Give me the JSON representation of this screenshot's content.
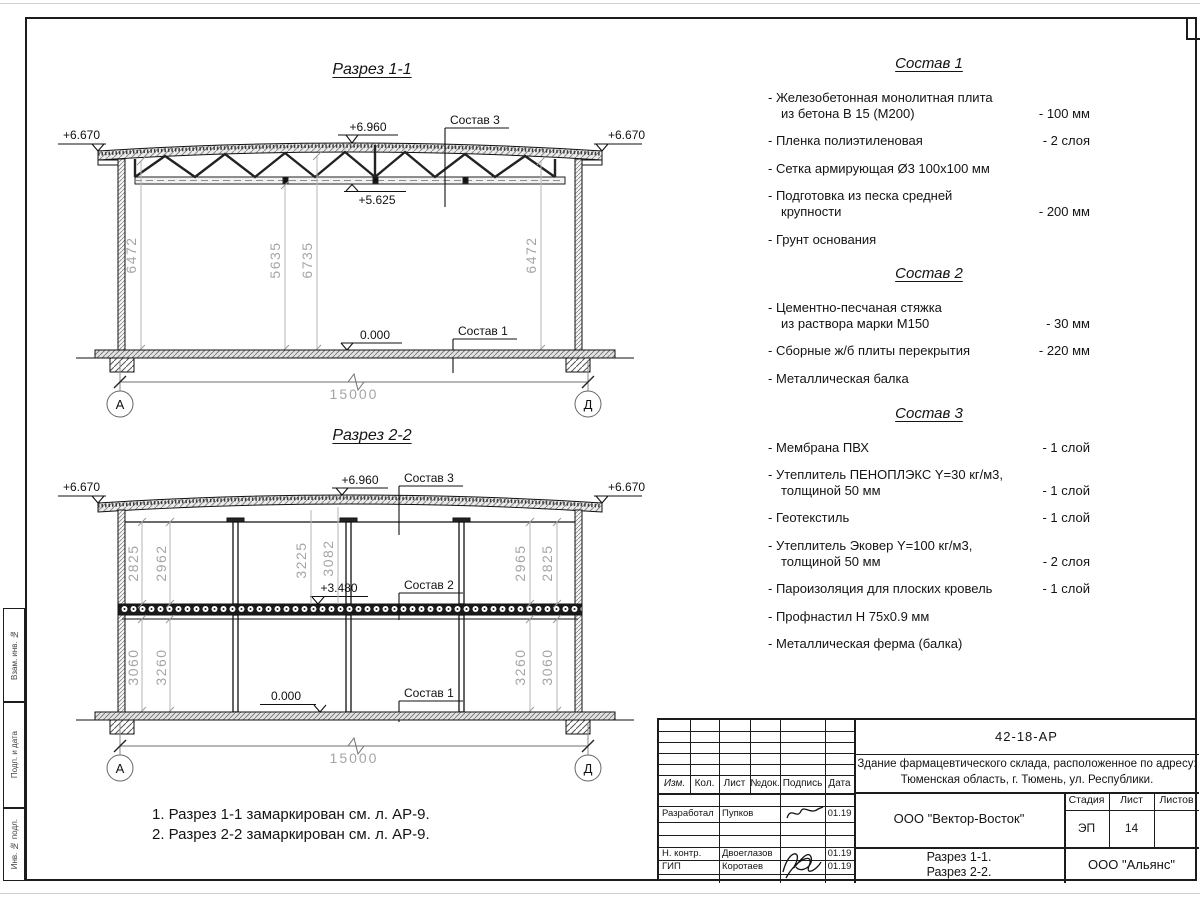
{
  "side_stamp": {
    "cells": [
      "Взам. инв. №",
      "Подп. и дата",
      "Инв. № подл."
    ]
  },
  "sections": {
    "s1": {
      "title": "Разрез 1-1",
      "elev_eave_left": "+6.670",
      "elev_eave_right": "+6.670",
      "elev_ridge": "+6.960",
      "elev_truss_bottom": "+5.625",
      "elev_floor": "0.000",
      "callout_roof": "Состав 3",
      "callout_floor": "Состав 1",
      "dims_vertical": {
        "left": "6472",
        "mid_a": "5635",
        "mid_b": "6735",
        "right": "6472"
      },
      "dim_span": "15000",
      "axis_left": "А",
      "axis_right": "Д"
    },
    "s2": {
      "title": "Разрез 2-2",
      "elev_eave_left": "+6.670",
      "elev_eave_right": "+6.670",
      "elev_ridge": "+6.960",
      "elev_mezzanine": "+3.480",
      "elev_floor": "0.000",
      "callout_roof": "Состав 3",
      "callout_mezz": "Состав 2",
      "callout_floor": "Состав 1",
      "dims_upper": {
        "l1": "2825",
        "l2": "2962",
        "m1": "3225",
        "m2": "3082",
        "r1": "2965",
        "r2": "2825"
      },
      "dims_lower": {
        "l1": "3060",
        "l2": "3260",
        "r1": "3260",
        "r2": "3060"
      },
      "dim_span": "15000",
      "axis_left": "А",
      "axis_right": "Д"
    }
  },
  "compositions": [
    {
      "title": "Состав 1",
      "items": [
        {
          "text": "- Железобетонная монолитная плита\nиз бетона В 15 (М200)",
          "value": "- 100 мм"
        },
        {
          "text": "- Пленка полиэтиленовая",
          "value": "- 2 слоя"
        },
        {
          "text": "- Сетка армирующая Ø3 100х100 мм",
          "value": ""
        },
        {
          "text": "- Подготовка из песка средней\nкрупности",
          "value": "- 200 мм"
        },
        {
          "text": "- Грунт основания",
          "value": ""
        }
      ]
    },
    {
      "title": "Состав 2",
      "items": [
        {
          "text": "- Цементно-песчаная стяжка\nиз раствора марки М150",
          "value": "- 30 мм"
        },
        {
          "text": "- Сборные ж/б плиты перекрытия",
          "value": "- 220 мм"
        },
        {
          "text": "- Металлическая балка",
          "value": ""
        }
      ]
    },
    {
      "title": "Состав 3",
      "items": [
        {
          "text": "- Мембрана ПВХ",
          "value": "- 1 слой"
        },
        {
          "text": "- Утеплитель ПЕНОПЛЭКС Y=30 кг/м3,\nтолщиной 50 мм",
          "value": "- 1 слой"
        },
        {
          "text": "- Геотекстиль",
          "value": "- 1 слой"
        },
        {
          "text": "- Утеплитель Эковер Y=100 кг/м3,\nтолщиной 50 мм",
          "value": "- 2 слоя"
        },
        {
          "text": "- Пароизоляция для плоских кровель",
          "value": "- 1 слой"
        },
        {
          "text": "- Профнастил Н 75х0.9 мм",
          "value": ""
        },
        {
          "text": "- Металлическая ферма (балка)",
          "value": ""
        }
      ]
    }
  ],
  "notes": [
    "1. Разрез 1-1 замаркирован см. л. АР-9.",
    "2. Разрез 2-2 замаркирован см. л. АР-9."
  ],
  "titleblock": {
    "doc_number": "42-18-АР",
    "project_line1": "Здание фармацевтического склада, расположенное по адресу:",
    "project_line2": "Тюменская область, г. Тюмень, ул. Республики.",
    "org_design": "ООО \"Вектор-Восток\"",
    "org_customer": "ООО \"Альянс\"",
    "sheet_title_line1": "Разрез 1-1.",
    "sheet_title_line2": "Разрез 2-2.",
    "col_izm": "Изм.",
    "col_kol": "Кол.",
    "col_list": "Лист",
    "col_ndok": "№док.",
    "col_podpis": "Подпись",
    "col_data": "Дата",
    "stage_label": "Стадия",
    "sheet_label": "Лист",
    "sheets_label": "Листов",
    "stage_value": "ЭП",
    "sheet_value": "14",
    "sheets_value": "",
    "rows": [
      {
        "role": "Разработал",
        "name": "Пупков",
        "date": "01.19"
      },
      {
        "role": "Н. контр.",
        "name": "Двоеглазов",
        "date": "01.19"
      },
      {
        "role": "ГИП",
        "name": "Коротаев",
        "date": "01.19"
      }
    ]
  }
}
